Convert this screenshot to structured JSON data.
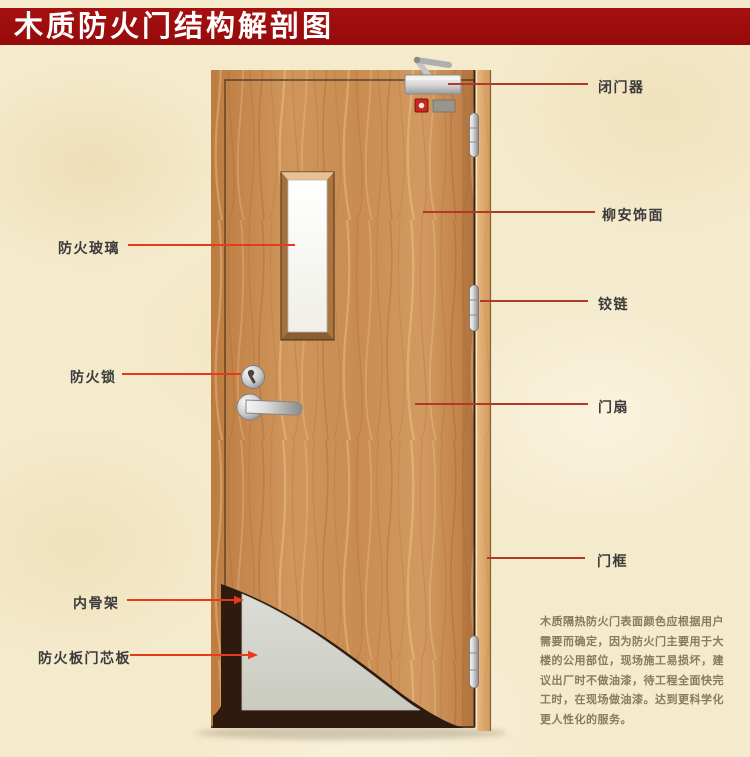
{
  "title": "木质防火门结构解剖图",
  "labels": {
    "door_closer": "闭门器",
    "lauan_veneer": "柳安饰面",
    "hinge": "铰链",
    "door_leaf": "门扇",
    "door_frame": "门框",
    "fire_glass": "防火玻璃",
    "fire_lock": "防火锁",
    "inner_skeleton": "内骨架",
    "fire_board_core": "防火板门芯板"
  },
  "description": {
    "lines": [
      "木质隔热防火门表面颜色应根据用户",
      "需要而确定，因为防火门主要用于大",
      "楼的公用部位，现场施工易损坏，建",
      "议出厂时不做油漆，待工程全面快完",
      "工时，在现场做油漆。达到更科学化",
      "更人性化的服务。"
    ]
  },
  "colors": {
    "banner": "#9E0C10",
    "background": "#F4EACC",
    "wood": "#CB8E53",
    "leader_left": "#E63A1A",
    "leader_right": "#B03A28",
    "core_gray": "#D4D5CD",
    "skeleton_dark": "#2E1A0E"
  }
}
